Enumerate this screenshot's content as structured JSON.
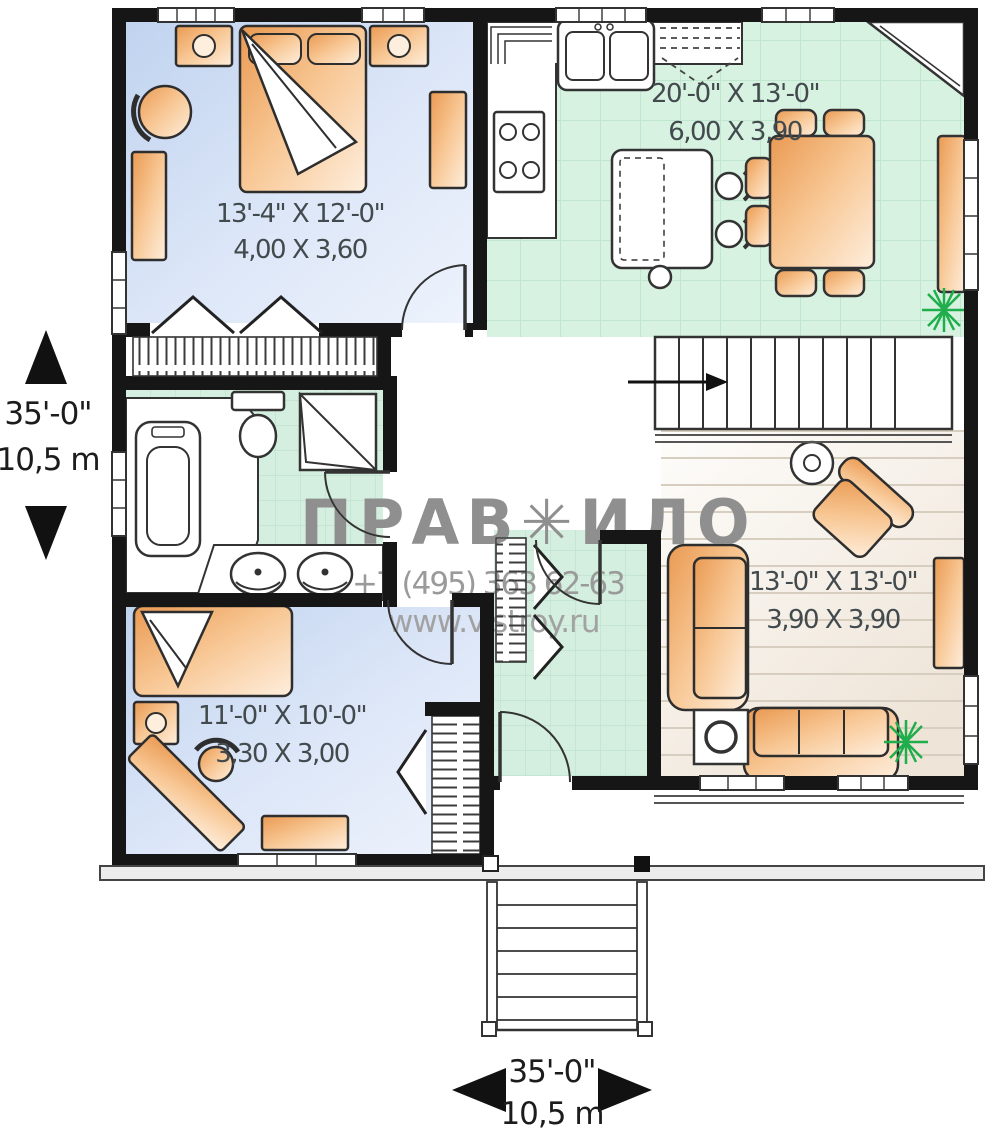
{
  "rooms": {
    "bedroom1": {
      "imperial": "13'-4\" X 12'-0\"",
      "metric": "4,00 X 3,60"
    },
    "kitchen_dining": {
      "imperial": "20'-0\" X 13'-0\"",
      "metric": "6,00 X 3,90"
    },
    "living": {
      "imperial": "13'-0\" X 13'-0\"",
      "metric": "3,90 X 3,90"
    },
    "bedroom2": {
      "imperial": "11'-0\" X 10'-0\"",
      "metric": "3,30 X 3,00"
    }
  },
  "dimensions": {
    "left": {
      "imperial": "35'-0\"",
      "metric": "10,5 m"
    },
    "bottom": {
      "imperial": "35'-0\"",
      "metric": "10,5 m"
    }
  },
  "watermark": {
    "title": "ПРАВ✳ИЛО",
    "phone": "+7 (495) 363 62-63",
    "website": "www.vistroy.ru"
  },
  "colors": {
    "wall": "#161616",
    "bedroom_floor": "#c5d6f0",
    "kitchen_floor": "#d7f2e1",
    "living_floor": "#efe6da",
    "furniture": "#ea9a52",
    "plant": "#1fae4b",
    "watermark_gray": "#8f8f8f"
  }
}
